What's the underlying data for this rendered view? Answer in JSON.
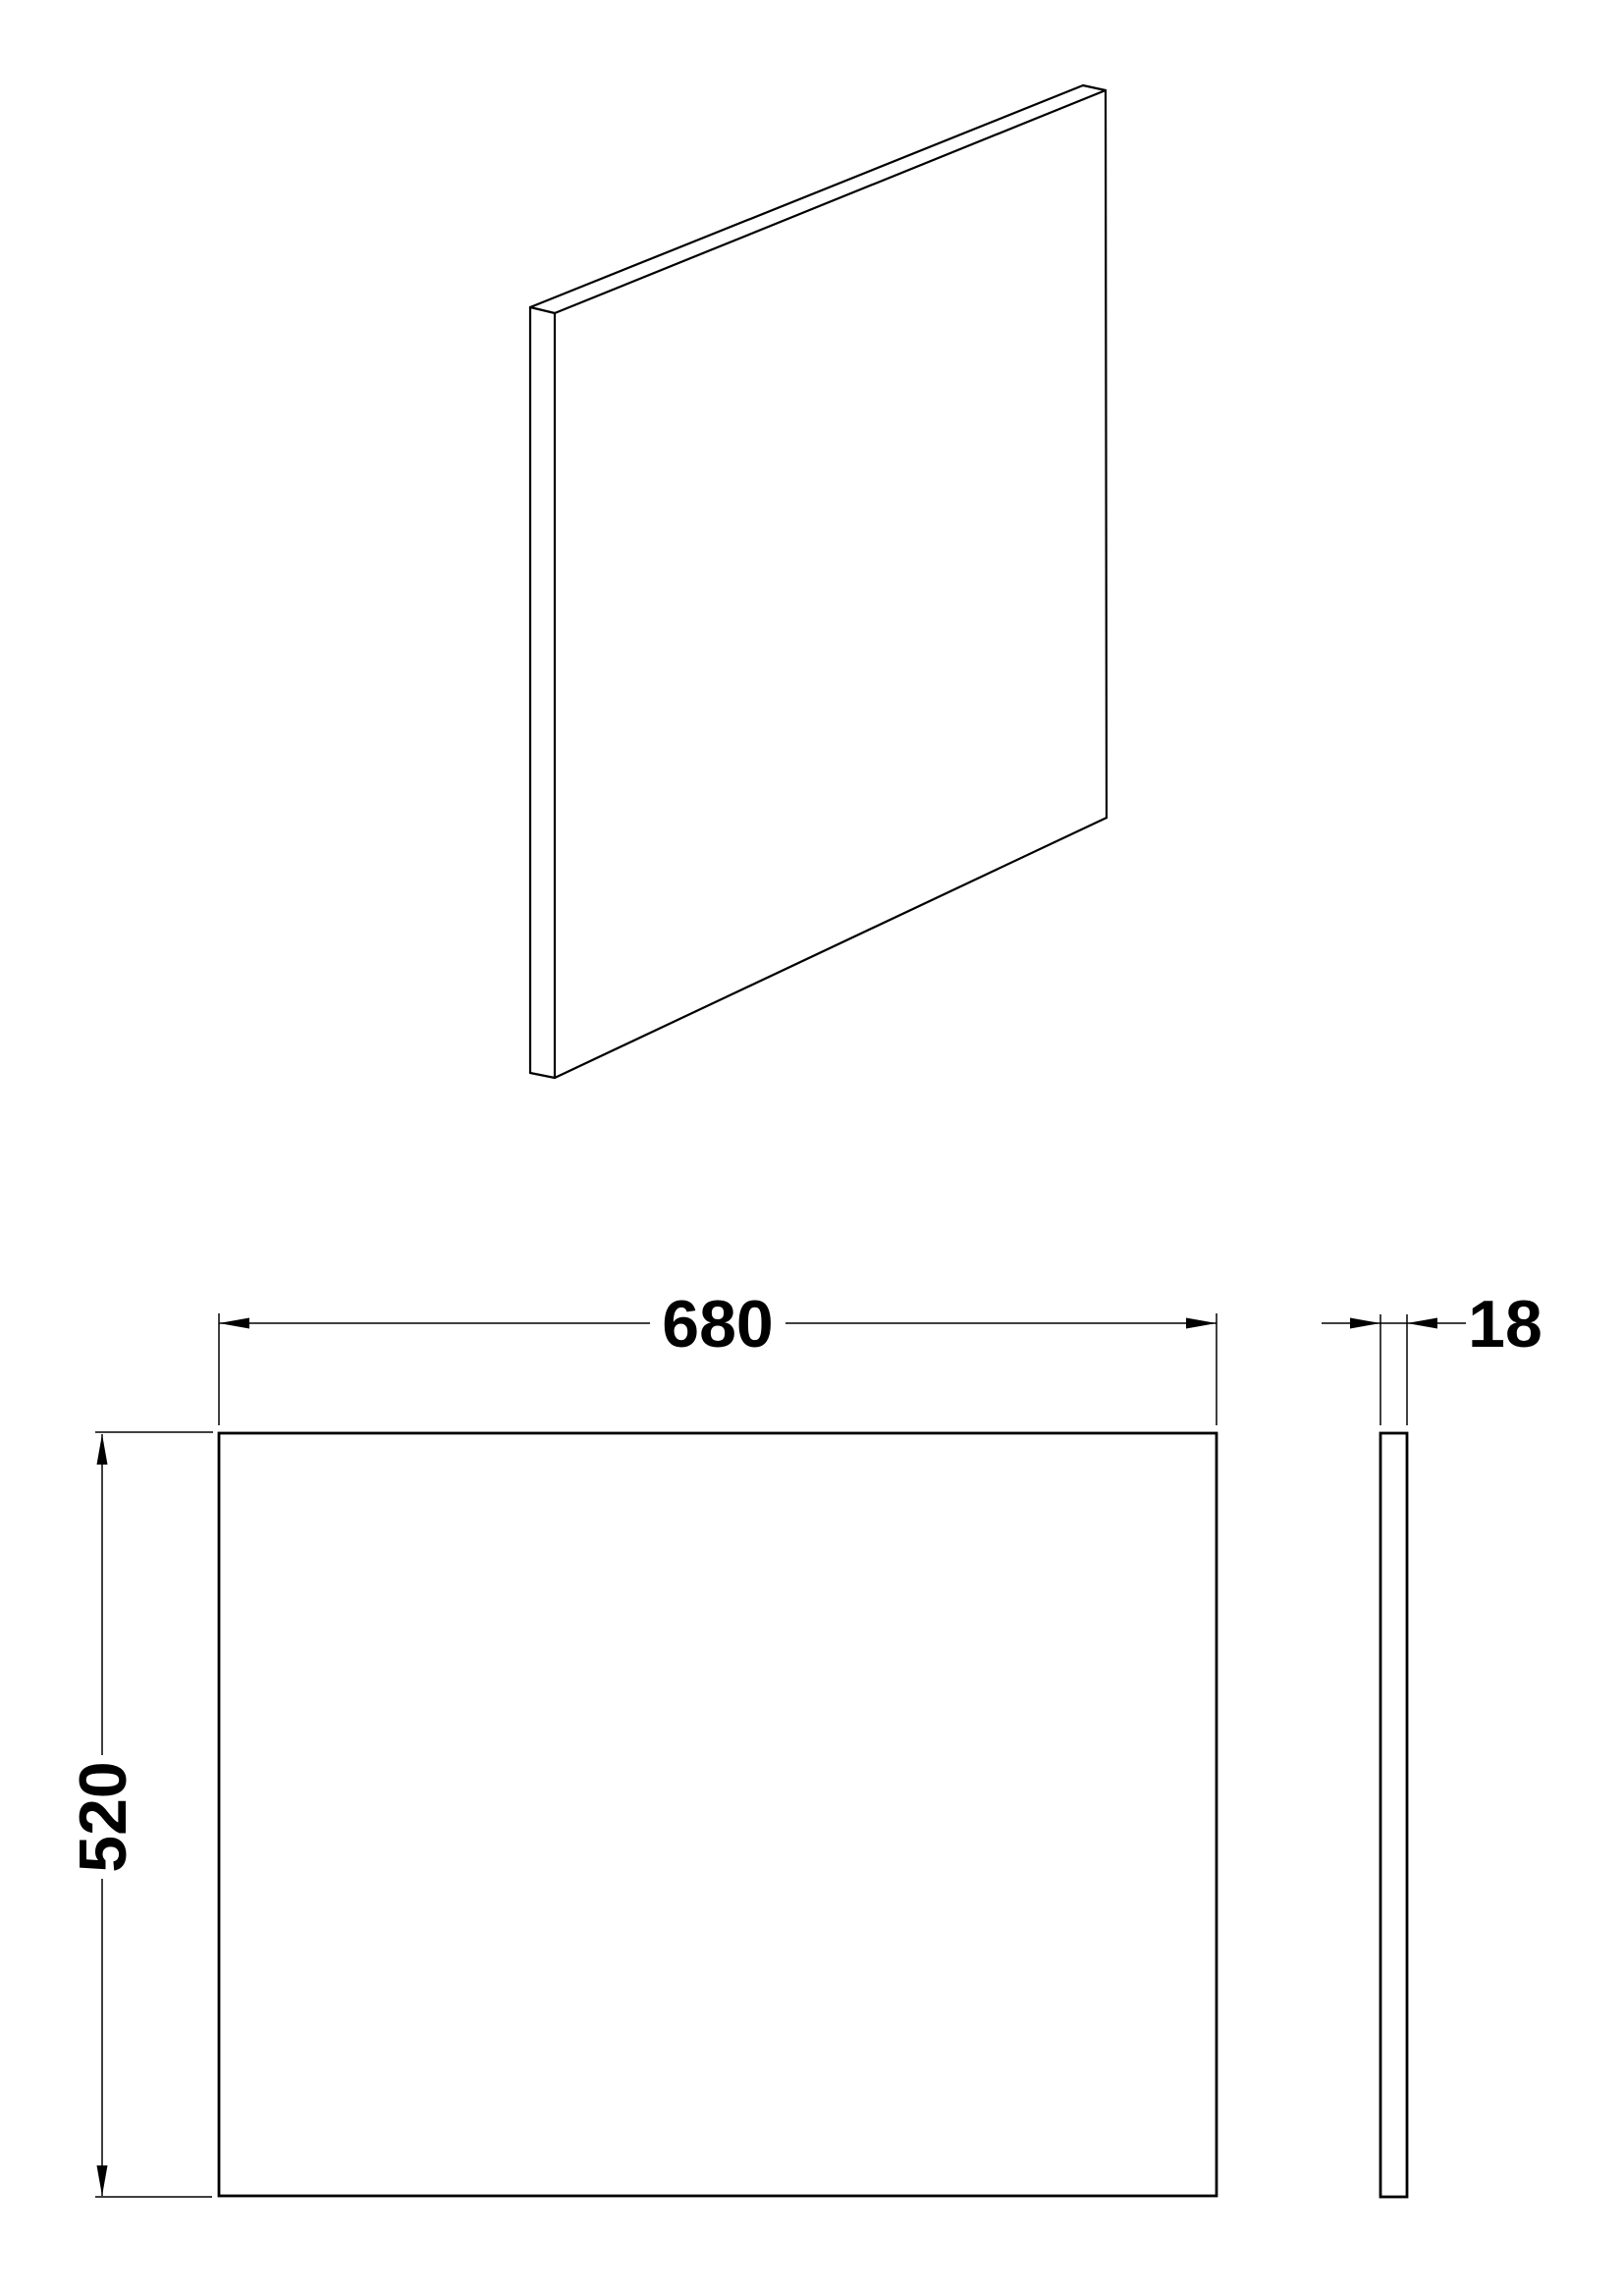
{
  "dimensions": {
    "width": {
      "value": "680"
    },
    "height": {
      "value": "520"
    },
    "thickness": {
      "value": "18"
    }
  },
  "colors": {
    "ink": "#000000",
    "background": "#ffffff"
  }
}
